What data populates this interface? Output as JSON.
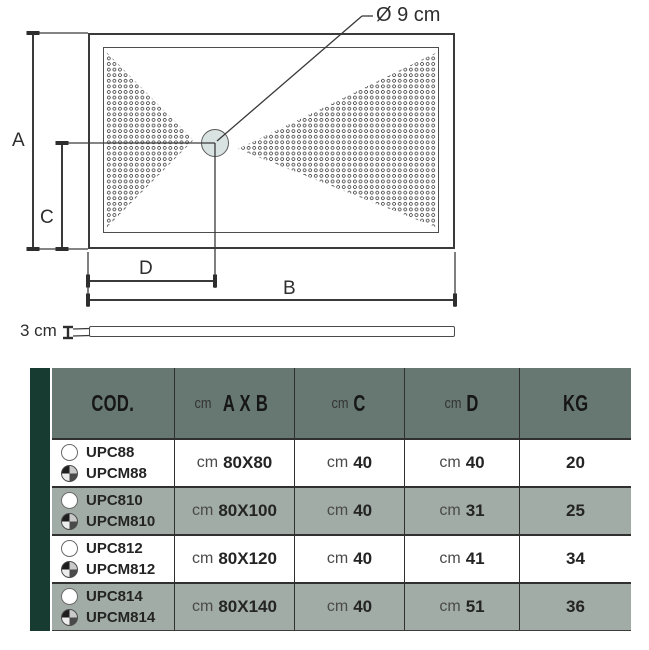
{
  "diagram": {
    "drain_diameter_label": "Ø 9 cm",
    "labels": {
      "a": "A",
      "b": "B",
      "c": "C",
      "d": "D"
    },
    "thickness_label": "3 cm"
  },
  "table": {
    "header": {
      "cod": "COD.",
      "axb_unit": "cm",
      "axb": "A X B",
      "c_unit": "cm",
      "c": "C",
      "d_unit": "cm",
      "d": "D",
      "kg": "KG"
    },
    "rows": [
      {
        "code_top": "UPC88",
        "code_bottom": "UPCM88",
        "unit": "cm",
        "axb": "80X80",
        "c": "40",
        "d": "40",
        "kg": "20"
      },
      {
        "code_top": "UPC810",
        "code_bottom": "UPCM810",
        "unit": "cm",
        "axb": "80X100",
        "c": "40",
        "d": "31",
        "kg": "25"
      },
      {
        "code_top": "UPC812",
        "code_bottom": "UPCM812",
        "unit": "cm",
        "axb": "80X120",
        "c": "40",
        "d": "41",
        "kg": "34"
      },
      {
        "code_top": "UPC814",
        "code_bottom": "UPCM814",
        "unit": "cm",
        "axb": "80X140",
        "c": "40",
        "d": "51",
        "kg": "36"
      }
    ]
  },
  "colors": {
    "accent_stripe": "#183b31",
    "header_bg": "#677872",
    "row_alt_bg": "#a2aca7",
    "table_border": "#303030",
    "drawing_line": "#3a3a3a",
    "drain_fill": "#d9e3e2"
  }
}
